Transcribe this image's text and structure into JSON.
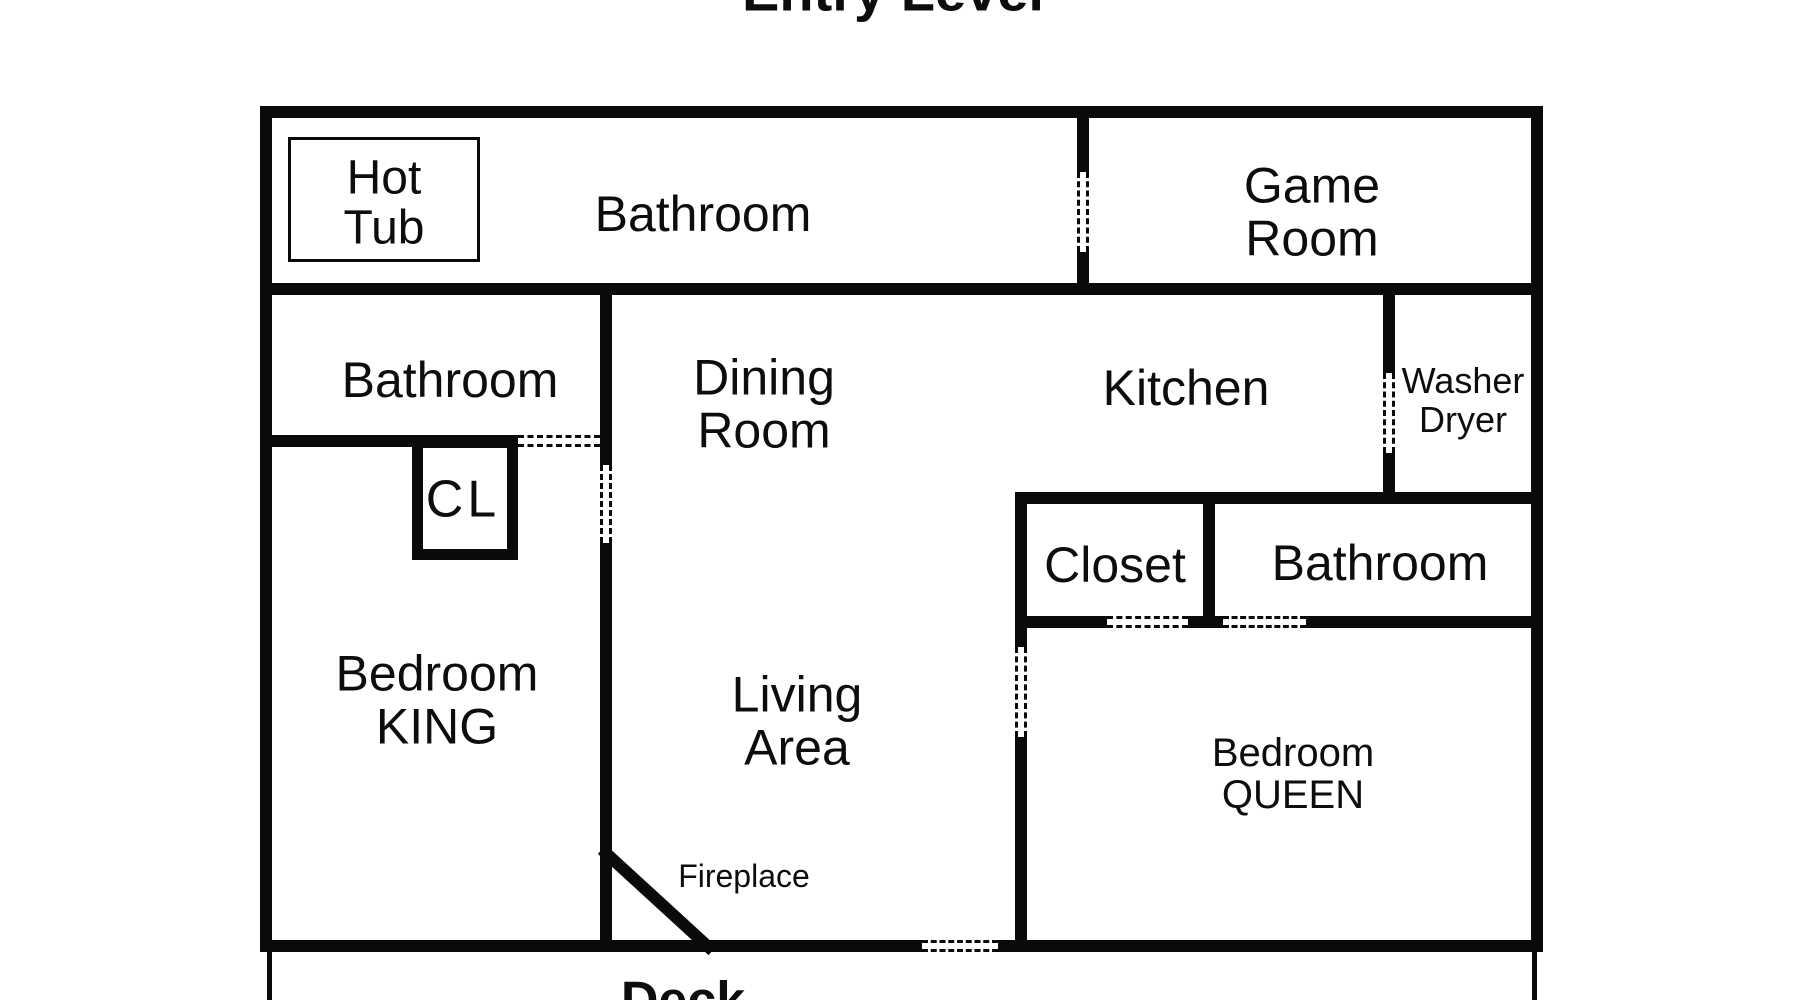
{
  "title": "Entry Level",
  "rooms": {
    "hot_tub": {
      "line1": "Hot",
      "line2": "Tub"
    },
    "bathroom_top": {
      "label": "Bathroom"
    },
    "game_room": {
      "line1": "Game",
      "line2": "Room"
    },
    "bathroom_left": {
      "label": "Bathroom"
    },
    "dining_room": {
      "line1": "Dining",
      "line2": "Room"
    },
    "kitchen": {
      "label": "Kitchen"
    },
    "washer_dryer": {
      "line1": "Washer",
      "line2": "Dryer"
    },
    "closet_cl": {
      "label": "CL"
    },
    "bedroom_king": {
      "line1": "Bedroom",
      "line2": "KING"
    },
    "living_area": {
      "line1": "Living",
      "line2": "Area"
    },
    "closet": {
      "label": "Closet"
    },
    "bathroom_right": {
      "label": "Bathroom"
    },
    "bedroom_queen": {
      "line1": "Bedroom",
      "line2": "QUEEN"
    },
    "fireplace": {
      "label": "Fireplace"
    },
    "deck": {
      "label": "Deck"
    }
  },
  "colors": {
    "wall": "#0a0a0a",
    "background": "#ffffff"
  }
}
